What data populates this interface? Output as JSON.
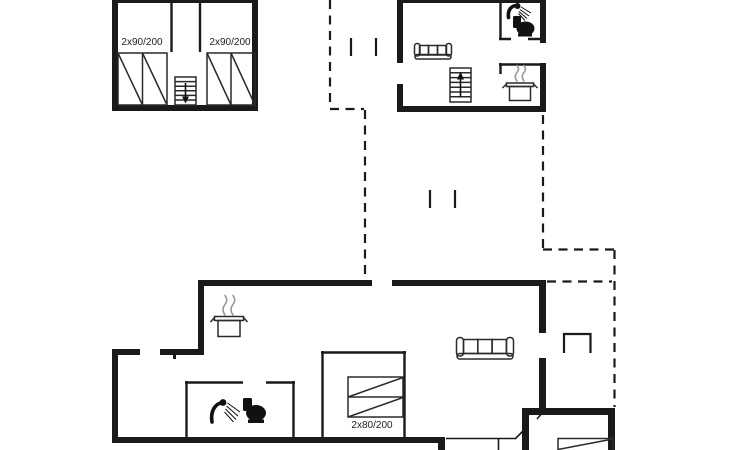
{
  "plan": {
    "type": "house-floor-plan",
    "colors": {
      "line": "#1a1a1a",
      "background": "#ffffff",
      "icon_fill": "#111111",
      "steam": "#9a9a9a"
    },
    "labels": {
      "bed_upper_left": "2x90/200",
      "bed_upper_right": "2x90/200",
      "bed_lower": "2x80/200"
    },
    "icons": {
      "stairs_down": "staircase-with-down-arrow",
      "stairs_up": "staircase-with-up-arrow",
      "sofa_annex": "three-seat-sofa",
      "sofa_living": "three-seat-sofa",
      "shower_annex": "shower-head-with-spray",
      "toilet_annex": "toilet",
      "stove_annex": "cooking-pot-with-steam",
      "stove_kitchen": "cooking-pot-with-steam",
      "shower_main": "shower-head-with-spray",
      "toilet_main": "toilet",
      "terrace_chair": "chair",
      "beds_double_90": "double-bed-symbol",
      "bed_double_80": "double-bed-symbol",
      "bed_cutoff": "bed-symbol-partial"
    }
  }
}
